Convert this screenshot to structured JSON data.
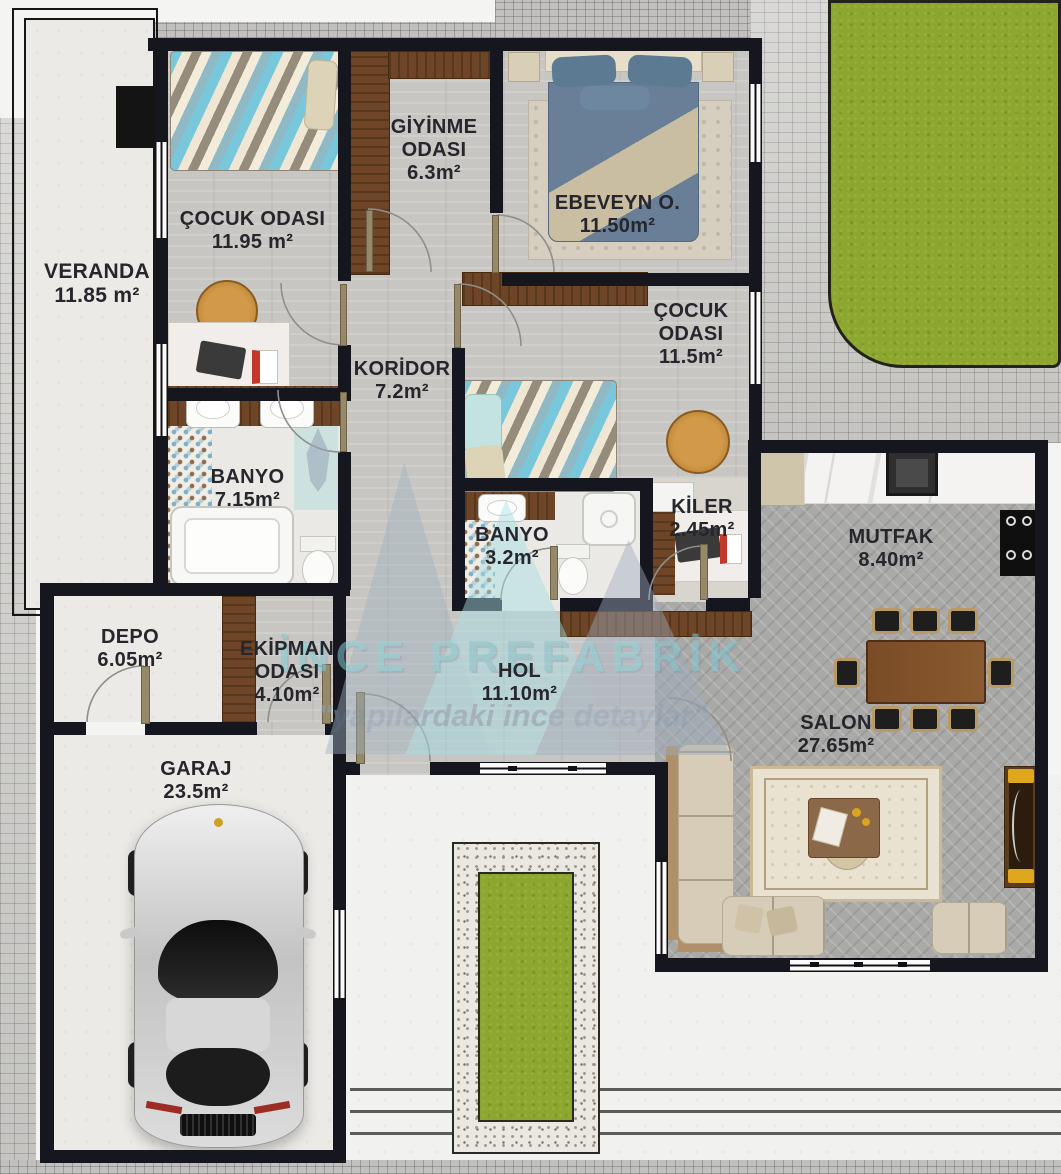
{
  "watermark": {
    "brand": "İNCE PREFABRİK",
    "tagline": "\"yapılardaki ince detaylar\""
  },
  "rooms": [
    {
      "id": "veranda",
      "name": "VERANDA",
      "area": "11.85 m²"
    },
    {
      "id": "cocuk-odasi-1",
      "name": "ÇOCUK ODASI",
      "area": "11.95 m²"
    },
    {
      "id": "giyinme-odasi",
      "name": "GİYİNME ODASI",
      "area": "6.3m²"
    },
    {
      "id": "ebeveyn-odasi",
      "name": "EBEVEYN O.",
      "area": "11.50m²"
    },
    {
      "id": "cocuk-odasi-2",
      "name": "ÇOCUK ODASI",
      "area": "11.5m²"
    },
    {
      "id": "koridor",
      "name": "KORİDOR",
      "area": "7.2m²"
    },
    {
      "id": "banyo-1",
      "name": "BANYO",
      "area": "7.15m²"
    },
    {
      "id": "banyo-2",
      "name": "BANYO",
      "area": "3.2m²"
    },
    {
      "id": "kiler",
      "name": "KİLER",
      "area": "2.45m²"
    },
    {
      "id": "mutfak",
      "name": "MUTFAK",
      "area": "8.40m²"
    },
    {
      "id": "depo",
      "name": "DEPO",
      "area": "6.05m²"
    },
    {
      "id": "ekipman-odasi",
      "name": "EKİPMAN ODASI",
      "area": "4.10m²"
    },
    {
      "id": "hol",
      "name": "HOL",
      "area": "11.10m²"
    },
    {
      "id": "salon",
      "name": "SALON",
      "area": "27.65m²"
    },
    {
      "id": "garaj",
      "name": "GARAJ",
      "area": "23.5m²"
    }
  ],
  "colors": {
    "wall": "#16161e",
    "lawn_green": "#8da62f",
    "wood_brown": "#6e4527",
    "watermark_teal": "#7fcbd6",
    "watermark_gray": "#9aa8ba"
  },
  "furniture_icons": [
    "single-bed-icon",
    "double-bed-icon",
    "wardrobe-icon",
    "desk-icon",
    "round-rug-icon",
    "bathtub-icon",
    "washbasin-icon",
    "toilet-icon",
    "shower-icon",
    "kitchen-counter-icon",
    "kitchen-sink-icon",
    "stove-icon",
    "dining-table-icon",
    "dining-chair-icon",
    "l-sofa-icon",
    "loveseat-icon",
    "coffee-table-icon",
    "area-rug-icon",
    "tv-unit-icon",
    "car-icon",
    "lawn-icon",
    "planter-icon"
  ]
}
